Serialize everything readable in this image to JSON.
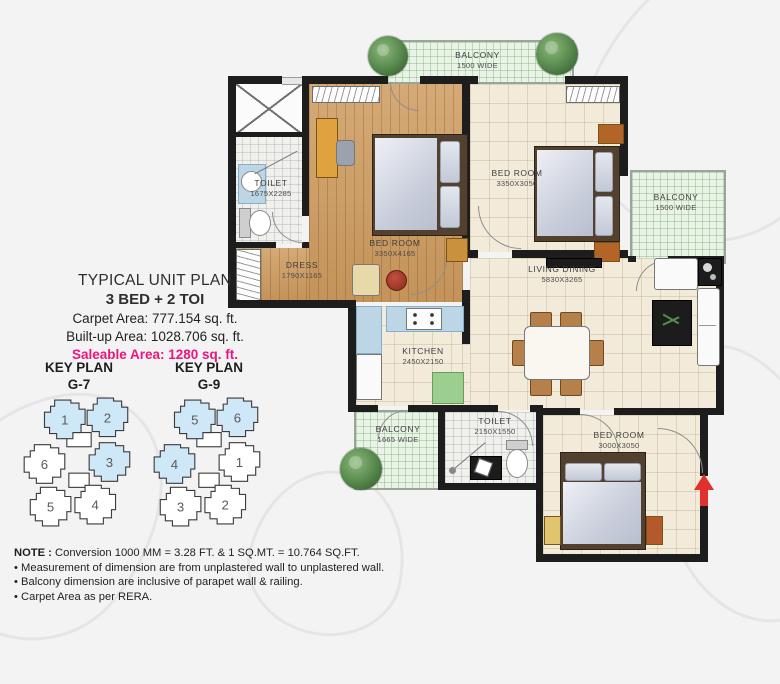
{
  "info": {
    "title": "TYPICAL UNIT PLAN",
    "subtitle": "3 BED + 2 TOI",
    "carpet": "Carpet Area: 777.154 sq. ft.",
    "builtup": "Built-up Area: 1028.706 sq. ft.",
    "saleable": "Saleable Area: 1280 sq. ft.",
    "saleable_color": "#ee147d"
  },
  "key_plans": [
    {
      "title": "KEY PLAN",
      "code": "G-7",
      "highlight_color": "#cfe8f8",
      "units": [
        {
          "num": "1",
          "fill": "#cfe8f8"
        },
        {
          "num": "2",
          "fill": "#cfe8f8"
        },
        {
          "num": "6",
          "fill": "#ffffff"
        },
        {
          "num": "3",
          "fill": "#cfe8f8"
        },
        {
          "num": "5",
          "fill": "#ffffff"
        },
        {
          "num": "4",
          "fill": "#ffffff"
        }
      ]
    },
    {
      "title": "KEY PLAN",
      "code": "G-9",
      "highlight_color": "#cfe8f8",
      "units": [
        {
          "num": "5",
          "fill": "#cfe8f8"
        },
        {
          "num": "6",
          "fill": "#cfe8f8"
        },
        {
          "num": "4",
          "fill": "#cfe8f8"
        },
        {
          "num": "1",
          "fill": "#ffffff"
        },
        {
          "num": "3",
          "fill": "#ffffff"
        },
        {
          "num": "2",
          "fill": "#ffffff"
        }
      ]
    }
  ],
  "rooms": {
    "balcony_top": {
      "name": "BALCONY",
      "dim": "1500 WIDE"
    },
    "toilet1": {
      "name": "TOILET",
      "dim": "1675X2285"
    },
    "bed1": {
      "name": "BED ROOM",
      "dim": "3350X4165"
    },
    "dress": {
      "name": "DRESS",
      "dim": "1790X1165"
    },
    "bed2": {
      "name": "BED ROOM",
      "dim": "3350X3050"
    },
    "balcony_right": {
      "name": "BALCONY",
      "dim": "1500 WIDE"
    },
    "living": {
      "name": "LIVING DINING",
      "dim": "5830X3265"
    },
    "kitchen": {
      "name": "KITCHEN",
      "dim": "2450X2150"
    },
    "balcony_bl": {
      "name": "BALCONY",
      "dim": "1665 WIDE"
    },
    "toilet2": {
      "name": "TOILET",
      "dim": "2150X1550"
    },
    "bed3": {
      "name": "BED ROOM",
      "dim": "3000X3050"
    }
  },
  "notes": {
    "heading": "NOTE : ",
    "conversion": "Conversion 1000 MM = 3.28 FT. & 1 SQ.MT. = 10.764 SQ.FT.",
    "bullets": [
      "• Measurement of dimension are from unplastered wall to unplastered wall.",
      "• Balcony dimension are inclusive of parapet wall & railing.",
      "• Carpet Area as per RERA."
    ]
  },
  "colors": {
    "entry_arrow": "#e0312d",
    "wall": "#1d1d1d",
    "wood_floor": "#cf9e63",
    "balcony_grid": "#e9f3e6"
  }
}
